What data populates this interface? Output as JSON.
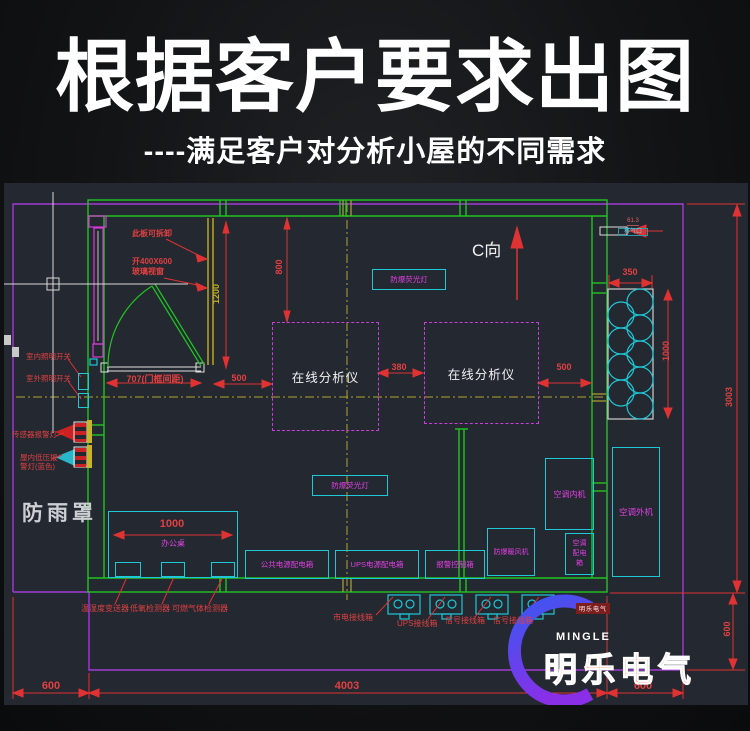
{
  "header": {
    "title": "根据客户要求出图",
    "subtitle": "----满足客户对分析小屋的不同需求"
  },
  "colors": {
    "canvas_bg": "#232831",
    "wall_green": "#21c421",
    "boundary_purple": "#a23ad6",
    "dim_red": "#e14040",
    "cad_cyan": "#1ec8d6",
    "cad_magenta": "#e23fe2",
    "centerline_yellow": "#b3a42e",
    "brand_orange": "#ff4e26",
    "watermark_blue": "#3a57f0",
    "watermark_purple": "#8a2fe8"
  },
  "drawing": {
    "annotations": {
      "removable_panel": "此板可拆卸",
      "window_line1": "开400X600",
      "window_line2": "玻璃视窗",
      "door_dim": "707(门框间距)",
      "indoor_light_switch": "室内照明开关",
      "outdoor_light_switch": "室外照明开关",
      "sensor_alarm_light": "传感器报警灯",
      "low_pressure_line1": "屋内低压报",
      "low_pressure_line2": "警灯(蓝色)",
      "rain_cover": "防雨罩",
      "desk": "办公桌",
      "temp_humidity": "温湿度变送器",
      "low_oxygen": "低氧检测器",
      "gas_detector": "可燃气体检测器",
      "analyzer": "在线分析仪",
      "fluorescent1": "防爆荧光灯",
      "fluorescent2": "防爆荧光灯",
      "c_direction": "C向",
      "vent_line1": "61.3",
      "vent_line2": "排气口",
      "public_power_box": "公共电源配电箱",
      "ups_power_box": "UPS电源配电箱",
      "alarm_control_box": "报警控制箱",
      "heater": "防爆暖风机",
      "ac_dist_line1": "空调",
      "ac_dist_line2": "配电",
      "ac_dist_line3": "箱",
      "ac_indoor": "空调内机",
      "ac_outdoor": "空调外机",
      "mains_jb": "市电接线箱",
      "ups_jb": "UPS接线箱",
      "signal_jb1": "信号接线箱",
      "signal_jb2": "信号接线箱"
    },
    "dimensions": {
      "d800": "800",
      "d1200": "1200",
      "d380": "380",
      "d500_left": "500",
      "d500_right": "500",
      "d350": "350",
      "d1000_rack": "1000",
      "d3003": "3003",
      "d600_right": "600",
      "d1000_desk": "1000",
      "d600_bottom_left": "600",
      "d4003": "4003",
      "d600_bottom_right": "600"
    }
  },
  "watermark": {
    "brand_en": "MINGLE",
    "brand_cn": "明乐电气",
    "seal": "明乐电气"
  }
}
